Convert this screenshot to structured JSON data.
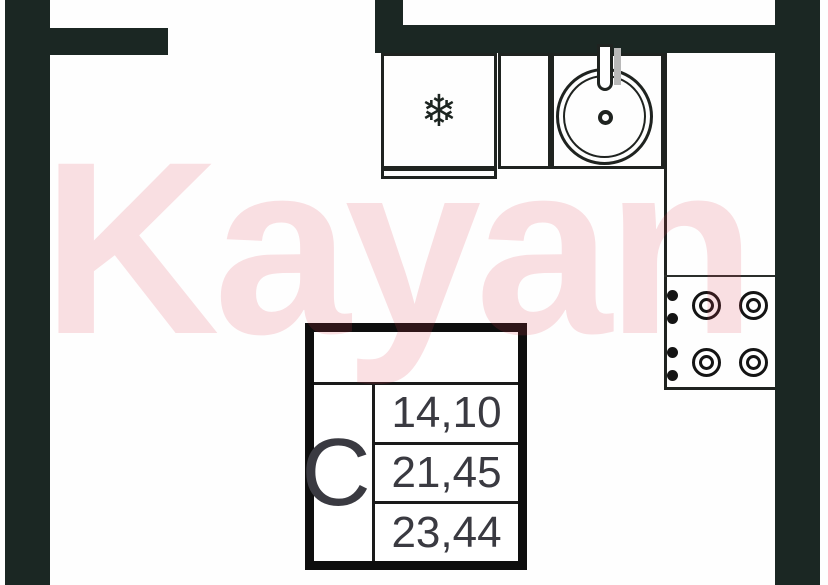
{
  "watermark": {
    "text": "Kayan"
  },
  "unit_card": {
    "type_letter": "С",
    "rows": [
      {
        "value": "14,10"
      },
      {
        "value": "21,45"
      },
      {
        "value": "23,44"
      }
    ]
  },
  "icons": {
    "fridge_glyph": "❄"
  },
  "colors": {
    "wall": "#1B2723",
    "counter_line": "#1F2320",
    "card_border": "#0E0E0E",
    "text_dark": "#3A3A41",
    "watermark_pink": "#DE4052"
  }
}
